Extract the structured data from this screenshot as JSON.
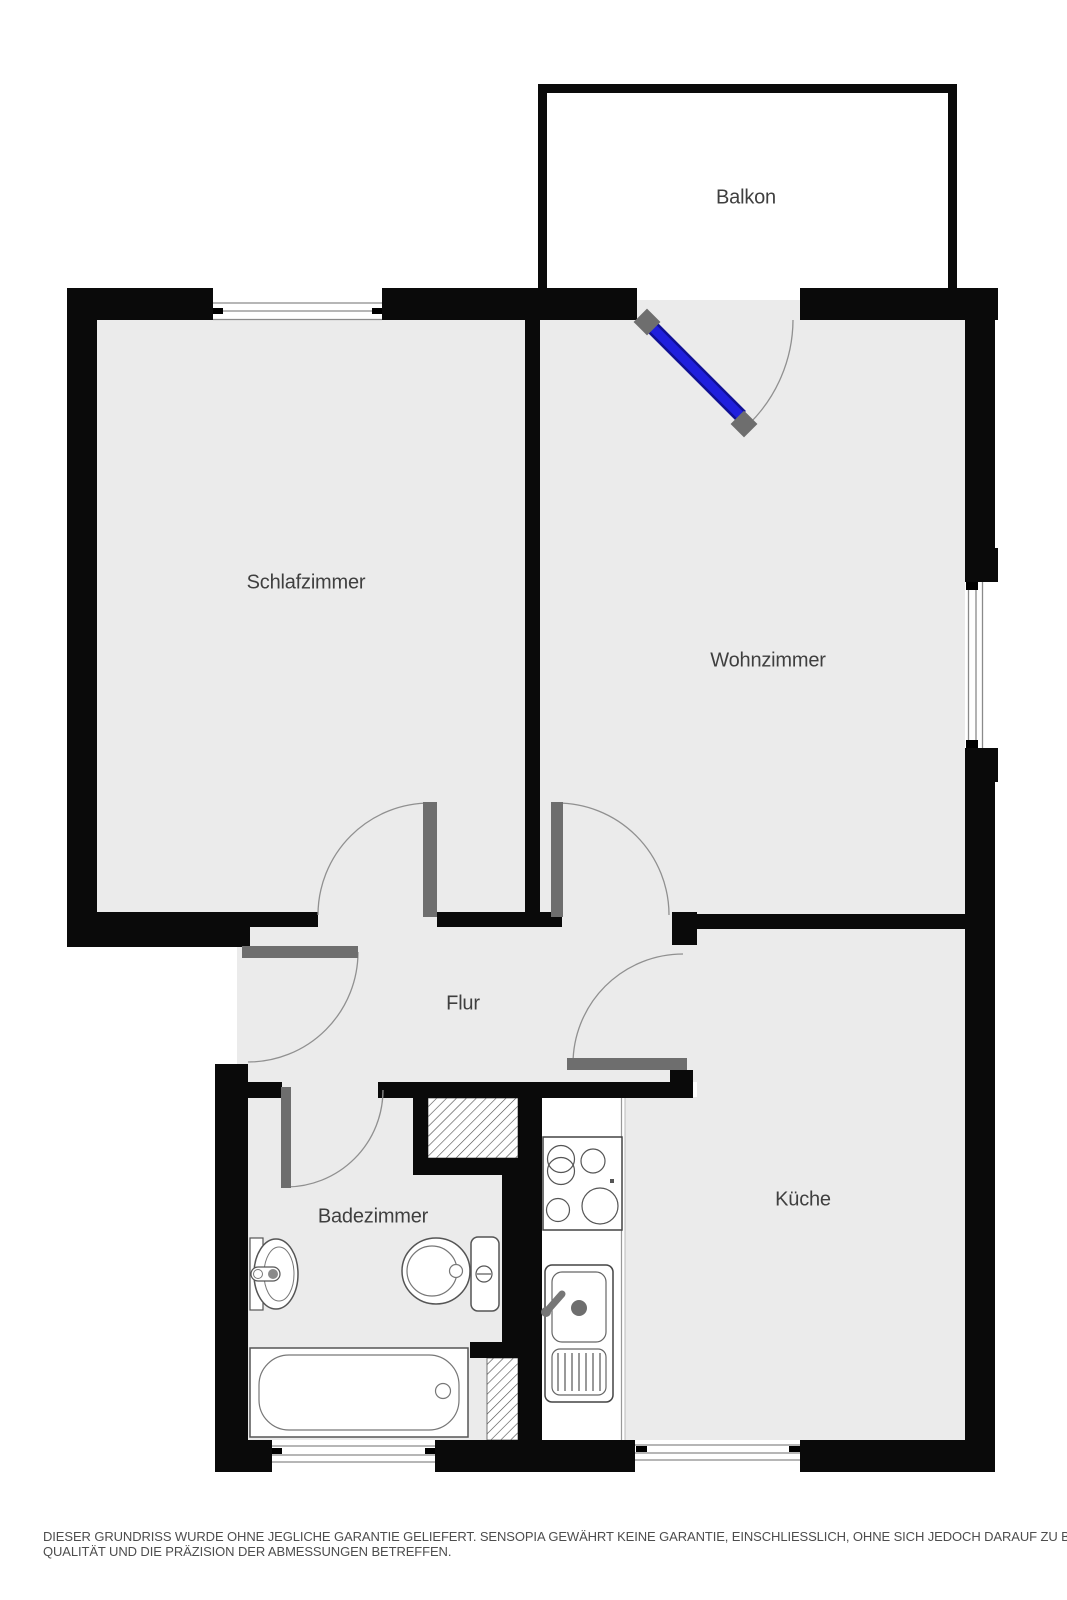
{
  "title": "Grundriss Wohnung",
  "rooms": {
    "balkon": {
      "label": "Balkon"
    },
    "schlafzimmer": {
      "label": "Schlafzimmer"
    },
    "wohnzimmer": {
      "label": "Wohnzimmer"
    },
    "flur": {
      "label": "Flur"
    },
    "badezimmer": {
      "label": "Badezimmer"
    },
    "kueche": {
      "label": "Küche"
    }
  },
  "disclaimer": {
    "line1": "DIESER GRUNDRISS WURDE OHNE JEGLICHE GARANTIE GELIEFERT. SENSOPIA GEWÄHRT KEINE GARANTIE, EINSCHLIESSLICH, OHNE SICH JEDOCH DARAUF ZU BESCHRÄNKEN, GARANTIEN, DIE DIE",
    "line2": "QUALITÄT UND DIE PRÄZISION DER ABMESSUNGEN BETREFFEN."
  },
  "colors": {
    "wall": "#0a0a0a",
    "floor": "#ebebeb",
    "door_leaf": "#6e6e6e",
    "balcony_door_blue": "#1f1fdd",
    "label_text": "#3f3f3f"
  }
}
